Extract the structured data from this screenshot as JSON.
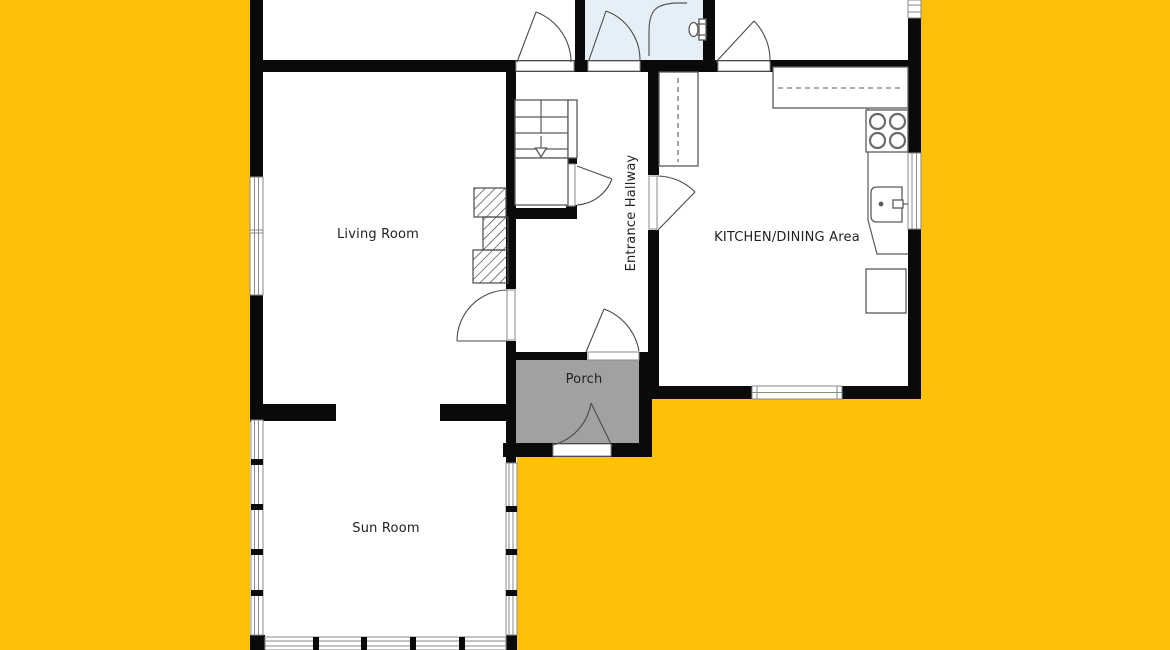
{
  "canvas": {
    "width": 1170,
    "height": 650
  },
  "colors": {
    "background": "#FFC107",
    "wall": "#0a0a0a",
    "floor": "#ffffff",
    "bathroom_floor": "#E4EFF8",
    "porch_floor": "#A1A1A1",
    "fixture_line": "#5a5a5a",
    "label_text": "#222222"
  },
  "rooms": [
    {
      "id": "living-room",
      "label": "Living Room"
    },
    {
      "id": "entrance-hallway",
      "label": "Entrance Hallway"
    },
    {
      "id": "kitchen-dining",
      "label": "KITCHEN/DINING Area"
    },
    {
      "id": "porch",
      "label": "Porch"
    },
    {
      "id": "sun-room",
      "label": "Sun Room"
    }
  ]
}
